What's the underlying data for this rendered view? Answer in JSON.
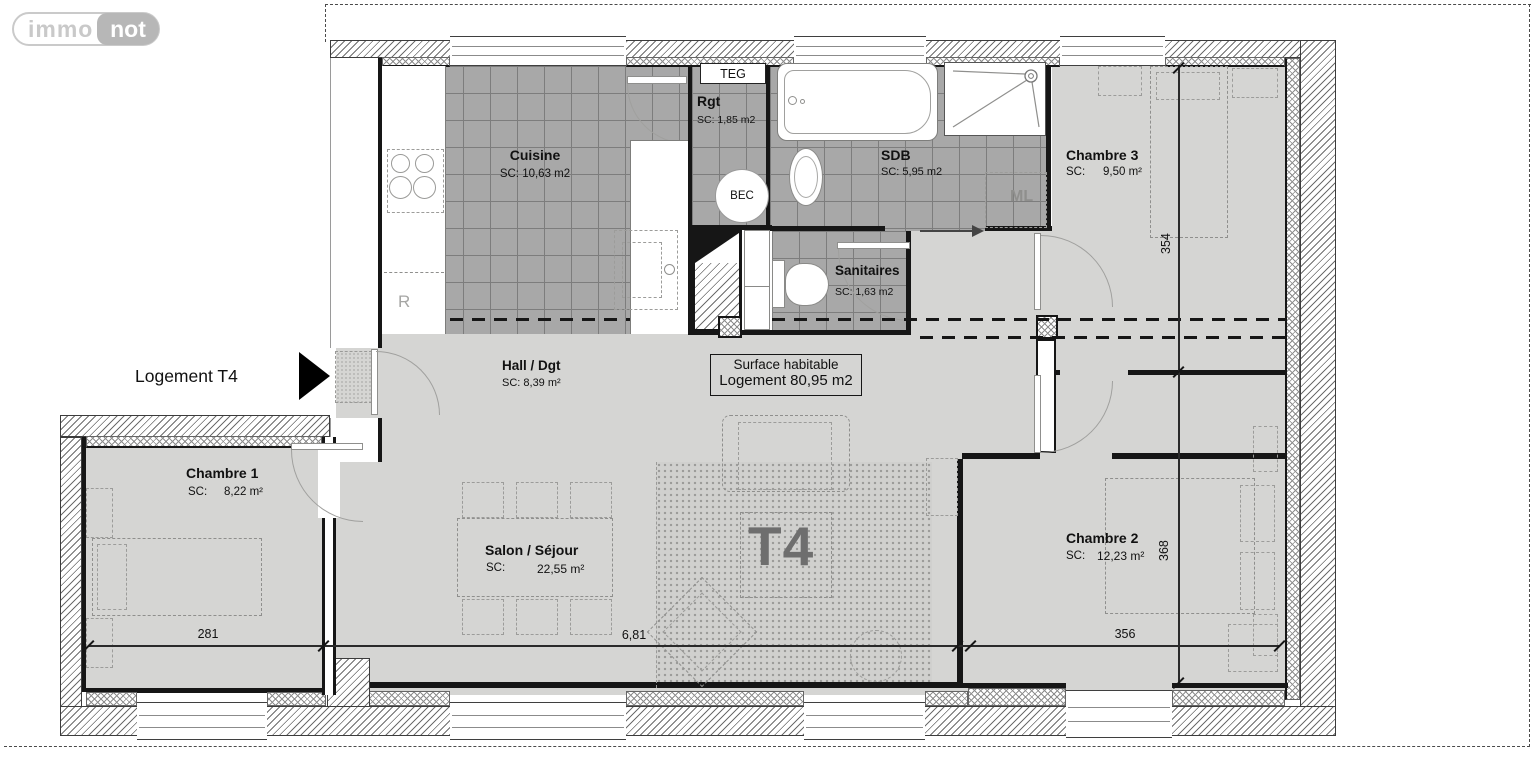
{
  "logo": {
    "immo": "immo",
    "not": "not"
  },
  "plan": {
    "unit_label": "Logement T4",
    "watermark": "T4",
    "surface_box": {
      "line1": "Surface habitable",
      "line2": "Logement 80,95 m2"
    }
  },
  "rooms": [
    {
      "id": "cuisine",
      "name": "Cuisine",
      "area": "SC: 10,63 m2"
    },
    {
      "id": "rgt",
      "name": "Rgt",
      "area": "SC: 1,85 m2"
    },
    {
      "id": "sdb",
      "name": "SDB",
      "area": "SC: 5,95 m2"
    },
    {
      "id": "sanitaires",
      "name": "Sanitaires",
      "area": "SC: 1,63 m2"
    },
    {
      "id": "chambre3",
      "name": "Chambre 3",
      "area_label": "SC:",
      "area_value": "9,50 m²"
    },
    {
      "id": "hall",
      "name": "Hall / Dgt",
      "area": "SC: 8,39 m²"
    },
    {
      "id": "chambre1",
      "name": "Chambre 1",
      "area_label": "SC:",
      "area_value": "8,22 m²"
    },
    {
      "id": "salon",
      "name": "Salon / Séjour",
      "area_label": "SC:",
      "area_value": "22,55 m²"
    },
    {
      "id": "chambre2",
      "name": "Chambre 2",
      "area_label": "SC:",
      "area_value": "12,23 m²"
    }
  ],
  "fixtures": {
    "teg": "TEG",
    "bec": "BEC",
    "ml": "ML",
    "fridge": "R"
  },
  "dimensions": {
    "chambre1_width": "281",
    "salon_width": "6,81",
    "chambre2_width": "356",
    "chambre3_depth": "354",
    "chambre2_depth": "368"
  },
  "colors": {
    "floor": "#d5d5d3",
    "tile": "#a8a8a8",
    "wall": "#161616",
    "t4_text": "#6e6e6e",
    "logo_gray": "#bdbdbd"
  }
}
